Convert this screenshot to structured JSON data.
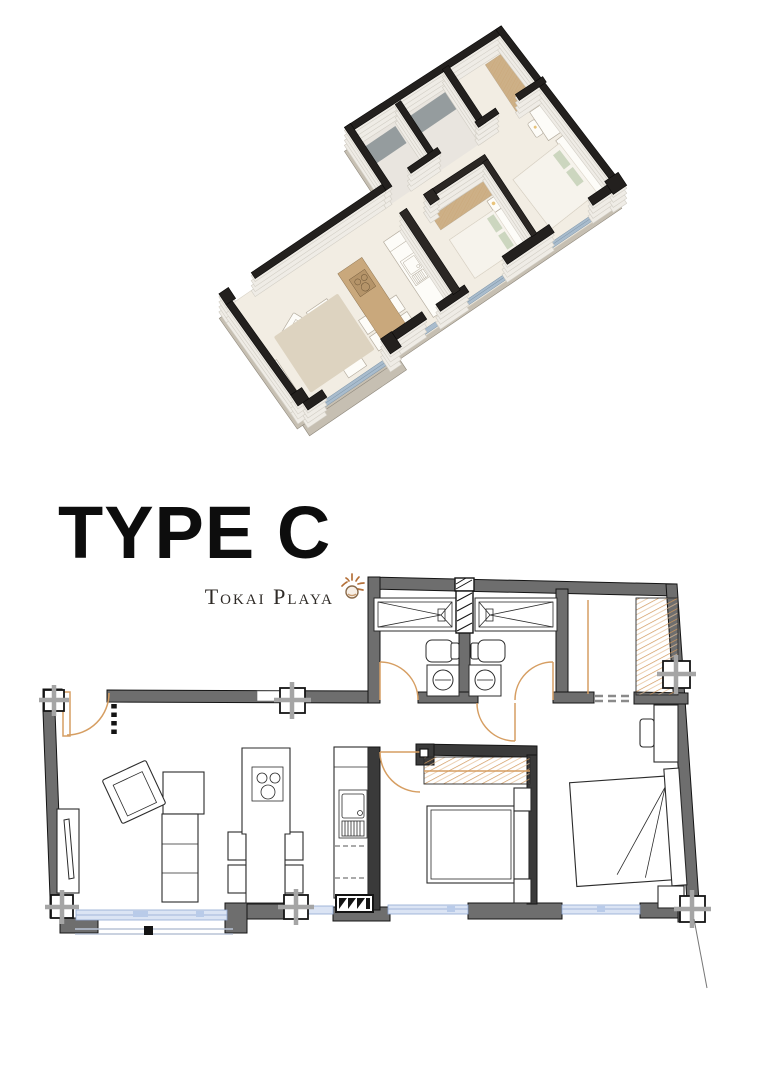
{
  "title": {
    "text": "TYPE C"
  },
  "brand": {
    "name": "Tokai Playa",
    "icon": "sun-icon"
  },
  "palette": {
    "page_bg": "#ffffff",
    "wall_gray": "#6e6e6e",
    "wall_dark": "#3a3a3a",
    "outline": "#141414",
    "door_orange": "#d69e62",
    "hatch_orange": "#d1985c",
    "window_blue_fill": "#dbe4f4",
    "window_blue_stroke": "#90a7d2",
    "iso_floor": "#f2ede3",
    "iso_wall_side": "#efece6",
    "iso_wall_cap": "#23201e",
    "wood": "#c9a87c"
  }
}
